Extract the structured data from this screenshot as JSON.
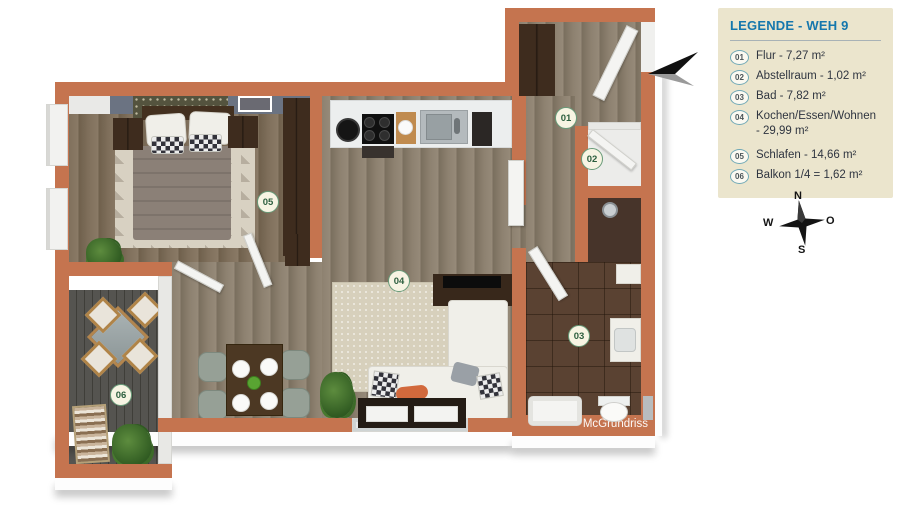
{
  "legend": {
    "title": "LEGENDE - WEH 9",
    "items": [
      {
        "num": "01",
        "label": "Flur - 7,27 m²"
      },
      {
        "num": "02",
        "label": "Abstellraum - 1,02 m²"
      },
      {
        "num": "03",
        "label": "Bad - 7,82 m²"
      },
      {
        "num": "04",
        "label": "Kochen/Essen/Wohnen\n- 29,99 m²"
      },
      {
        "num": "05",
        "label": "Schlafen - 14,66 m²"
      },
      {
        "num": "06",
        "label": "Balkon 1/4 = 1,62 m²"
      }
    ]
  },
  "plan": {
    "watermark": "McGrundriss",
    "room_badges": [
      {
        "num": "01",
        "room": "flur"
      },
      {
        "num": "02",
        "room": "abstellraum"
      },
      {
        "num": "03",
        "room": "bad"
      },
      {
        "num": "04",
        "room": "kochen-essen-wohnen"
      },
      {
        "num": "05",
        "room": "schlafen"
      },
      {
        "num": "06",
        "room": "balkon"
      }
    ]
  },
  "compass": {
    "n": "N",
    "o": "O",
    "s": "S",
    "w": "W"
  },
  "colors": {
    "wall": "#c5744f",
    "accentWall": "#6b7382",
    "rug": "#d7d0bc",
    "legendBg": "#ebe5cd",
    "legendTitle": "#1577ad",
    "legendText": "#2f3540",
    "badgeRing": "#679a78",
    "badgeText": "#2c5e3e"
  }
}
